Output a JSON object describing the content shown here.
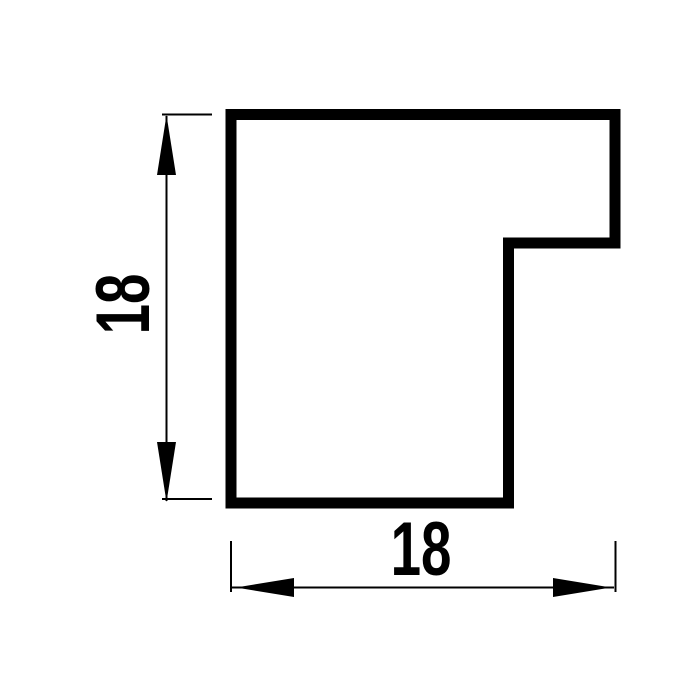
{
  "page": {
    "background_color": "#ffffff"
  },
  "drawing": {
    "kind": "profile-cross-section",
    "line_color": "#000000",
    "height_dimension": {
      "label": "18"
    },
    "width_dimension": {
      "label": "18"
    }
  }
}
